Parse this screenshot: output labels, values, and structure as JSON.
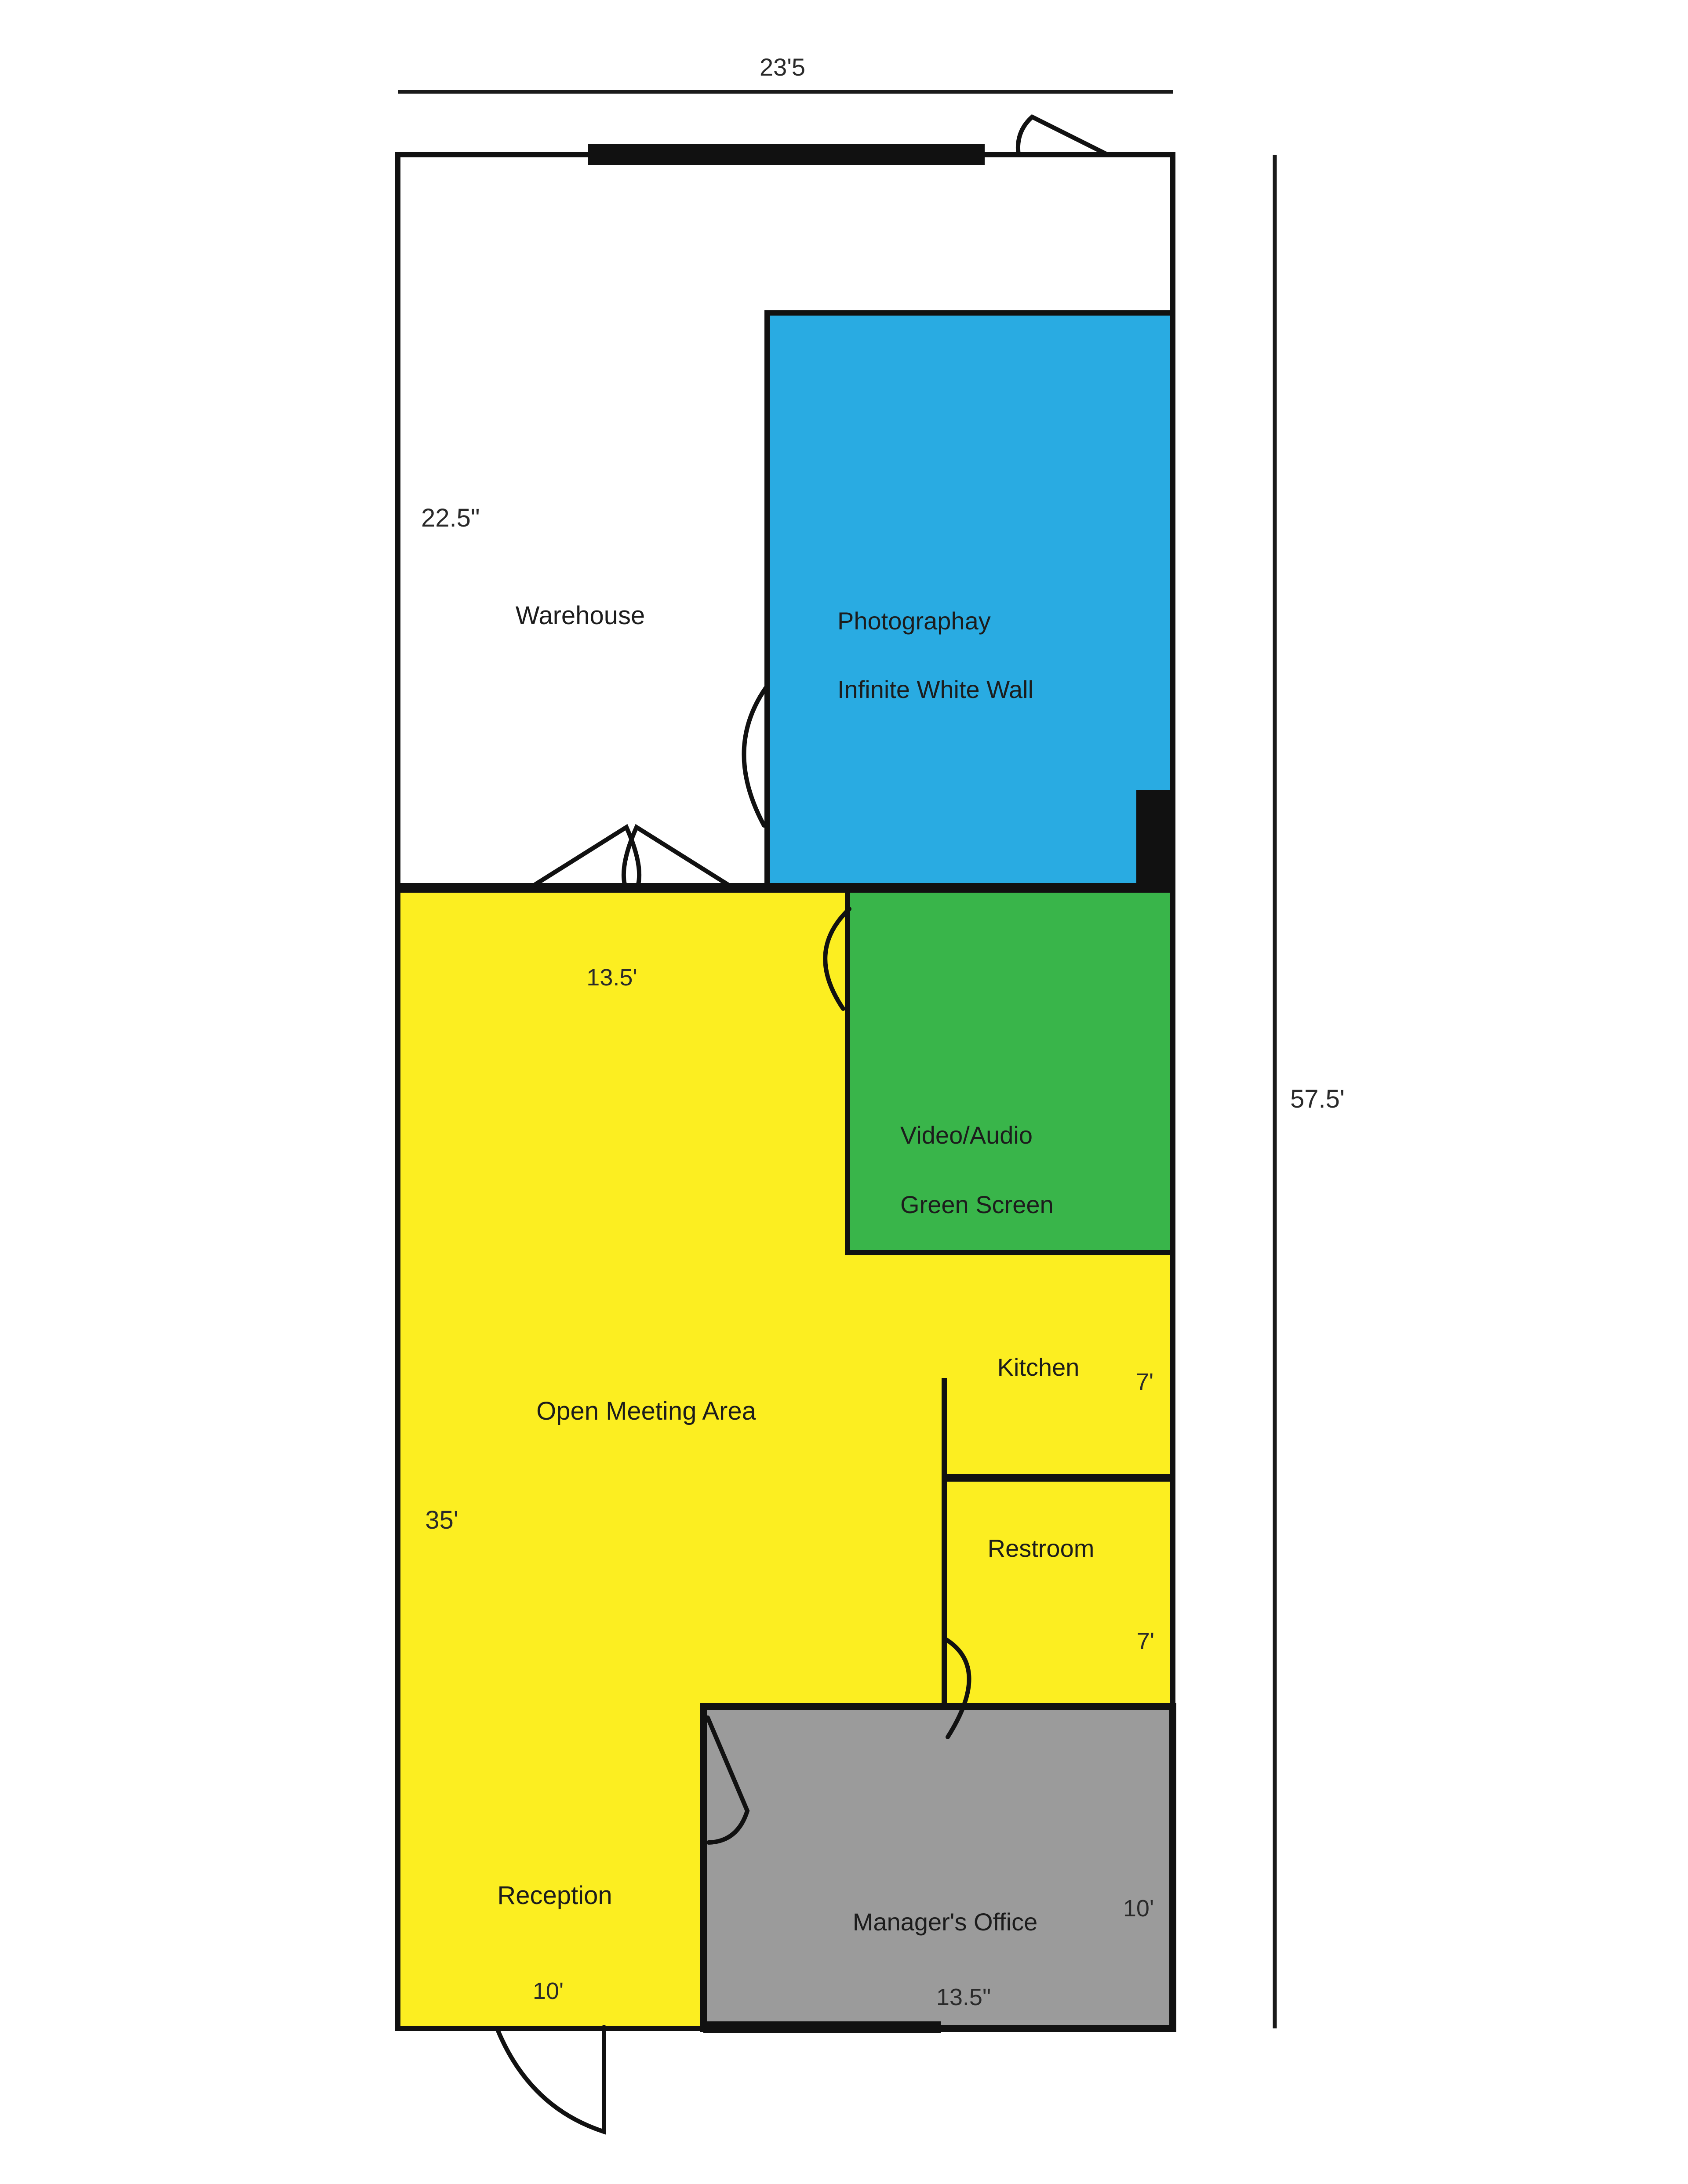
{
  "title": "Studio floor plan",
  "rooms": {
    "warehouse": {
      "label": "Warehouse"
    },
    "photography": {
      "label_line1": "Photographay",
      "label_line2": "Infinite White Wall",
      "color": "#29ABE2"
    },
    "green_screen": {
      "label_line1": "Video/Audio",
      "label_line2": "Green Screen",
      "color": "#39B54A"
    },
    "open_meeting": {
      "label": "Open Meeting Area",
      "color": "#FCEE21"
    },
    "kitchen": {
      "label": "Kitchen"
    },
    "restroom": {
      "label": "Restroom"
    },
    "reception": {
      "label": "Reception"
    },
    "managers_office": {
      "label": "Manager's Office",
      "color": "#9B9B9B"
    }
  },
  "dimensions": {
    "overall_width": "23'5",
    "overall_height": "57.5'",
    "warehouse_width": "22.5\"",
    "meeting_width": "13.5'",
    "meeting_height": "35'",
    "kitchen_depth": "7'",
    "restroom_depth": "7'",
    "reception_width": "10'",
    "office_height": "10'",
    "office_width": "13.5\""
  },
  "colors": {
    "wall": "#111111",
    "photography_blue": "#29ABE2",
    "green_screen_green": "#39B54A",
    "common_yellow": "#FCEE21",
    "office_gray": "#9B9B9B",
    "background": "#FFFFFF"
  }
}
